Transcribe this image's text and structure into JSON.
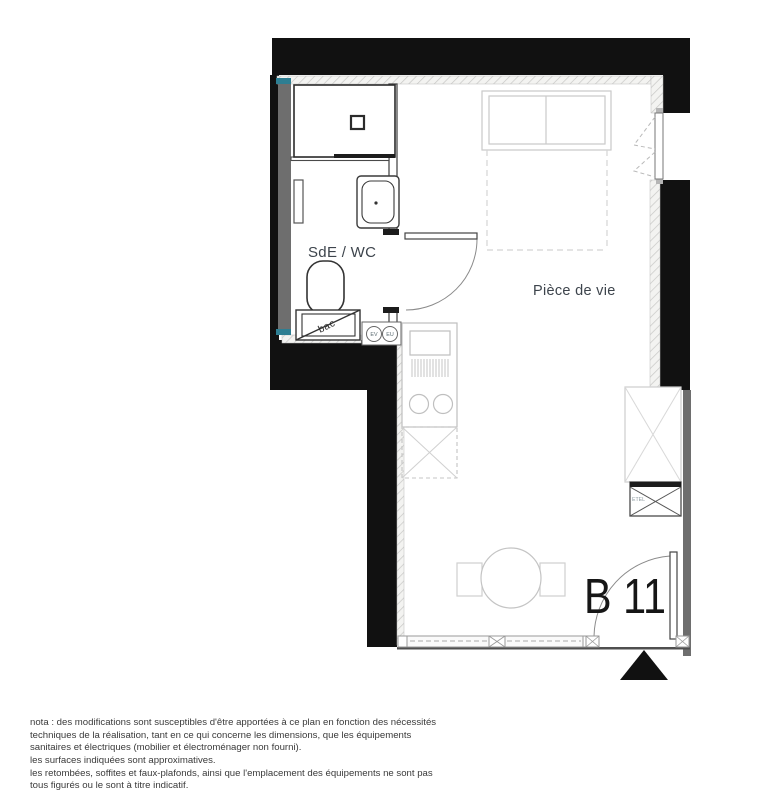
{
  "plan": {
    "unit_label": "B 11",
    "rooms": {
      "bathroom": "SdE / WC",
      "living": "Pièce de vie"
    },
    "annotations": {
      "bac": "bac",
      "ev": "EV",
      "eu": "EU",
      "etel": "ETEL"
    }
  },
  "note": {
    "lines": [
      "nota : des modifications sont susceptibles d'être apportées à ce plan en fonction des nécessités",
      "techniques de la réalisation, tant en ce qui concerne les dimensions, que les équipements",
      "sanitaires et électriques (mobilier et électroménager non fourni).",
      "les surfaces indiquées sont approximatives.",
      "les retombées, soffites et faux-plafonds, ainsi que l'emplacement des équipements ne sont pas",
      "tous figurés ou le sont à titre indicatif."
    ]
  },
  "colors": {
    "wall": "#111111",
    "wall_lining": "#6e6e6e",
    "accent_teal": "#2e7e92",
    "furniture_line": "#c9c9c9",
    "fixture_line": "#3a3a3a",
    "label_text": "#3d444c"
  }
}
